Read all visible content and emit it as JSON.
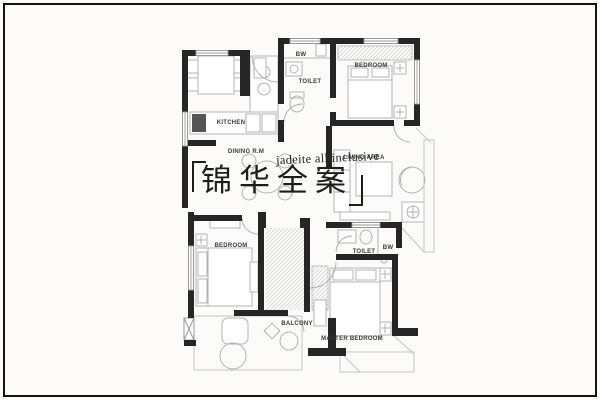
{
  "title": {
    "english": "jadeite all inclusive",
    "chinese": "锦华全案",
    "chinese_chars": [
      "锦",
      "华",
      "全",
      "案"
    ]
  },
  "rooms": [
    {
      "key": "kitchen",
      "label": "KITCHEN"
    },
    {
      "key": "dining",
      "label": "DINING R.M"
    },
    {
      "key": "bw-top",
      "label": "BW"
    },
    {
      "key": "toilet-top",
      "label": "TOILET"
    },
    {
      "key": "bedroom-top",
      "label": "BEDROOM"
    },
    {
      "key": "living",
      "label": "LIVING AREA"
    },
    {
      "key": "bedroom-lower",
      "label": "BEDROOM"
    },
    {
      "key": "balcony",
      "label": "BALCONY"
    },
    {
      "key": "toilet-lower",
      "label": "TOILET"
    },
    {
      "key": "bw-lower",
      "label": "BW"
    },
    {
      "key": "master-bedroom",
      "label": "MASTER BEDROOM"
    }
  ],
  "colors": {
    "wall": "#262626",
    "furniture_line": "#b3b3b3",
    "hatch_line": "#cccccc",
    "label_text": "#3a3a3a",
    "title_text": "#1c1c1c",
    "background": "#fcfbfa",
    "frame": "#141414"
  }
}
